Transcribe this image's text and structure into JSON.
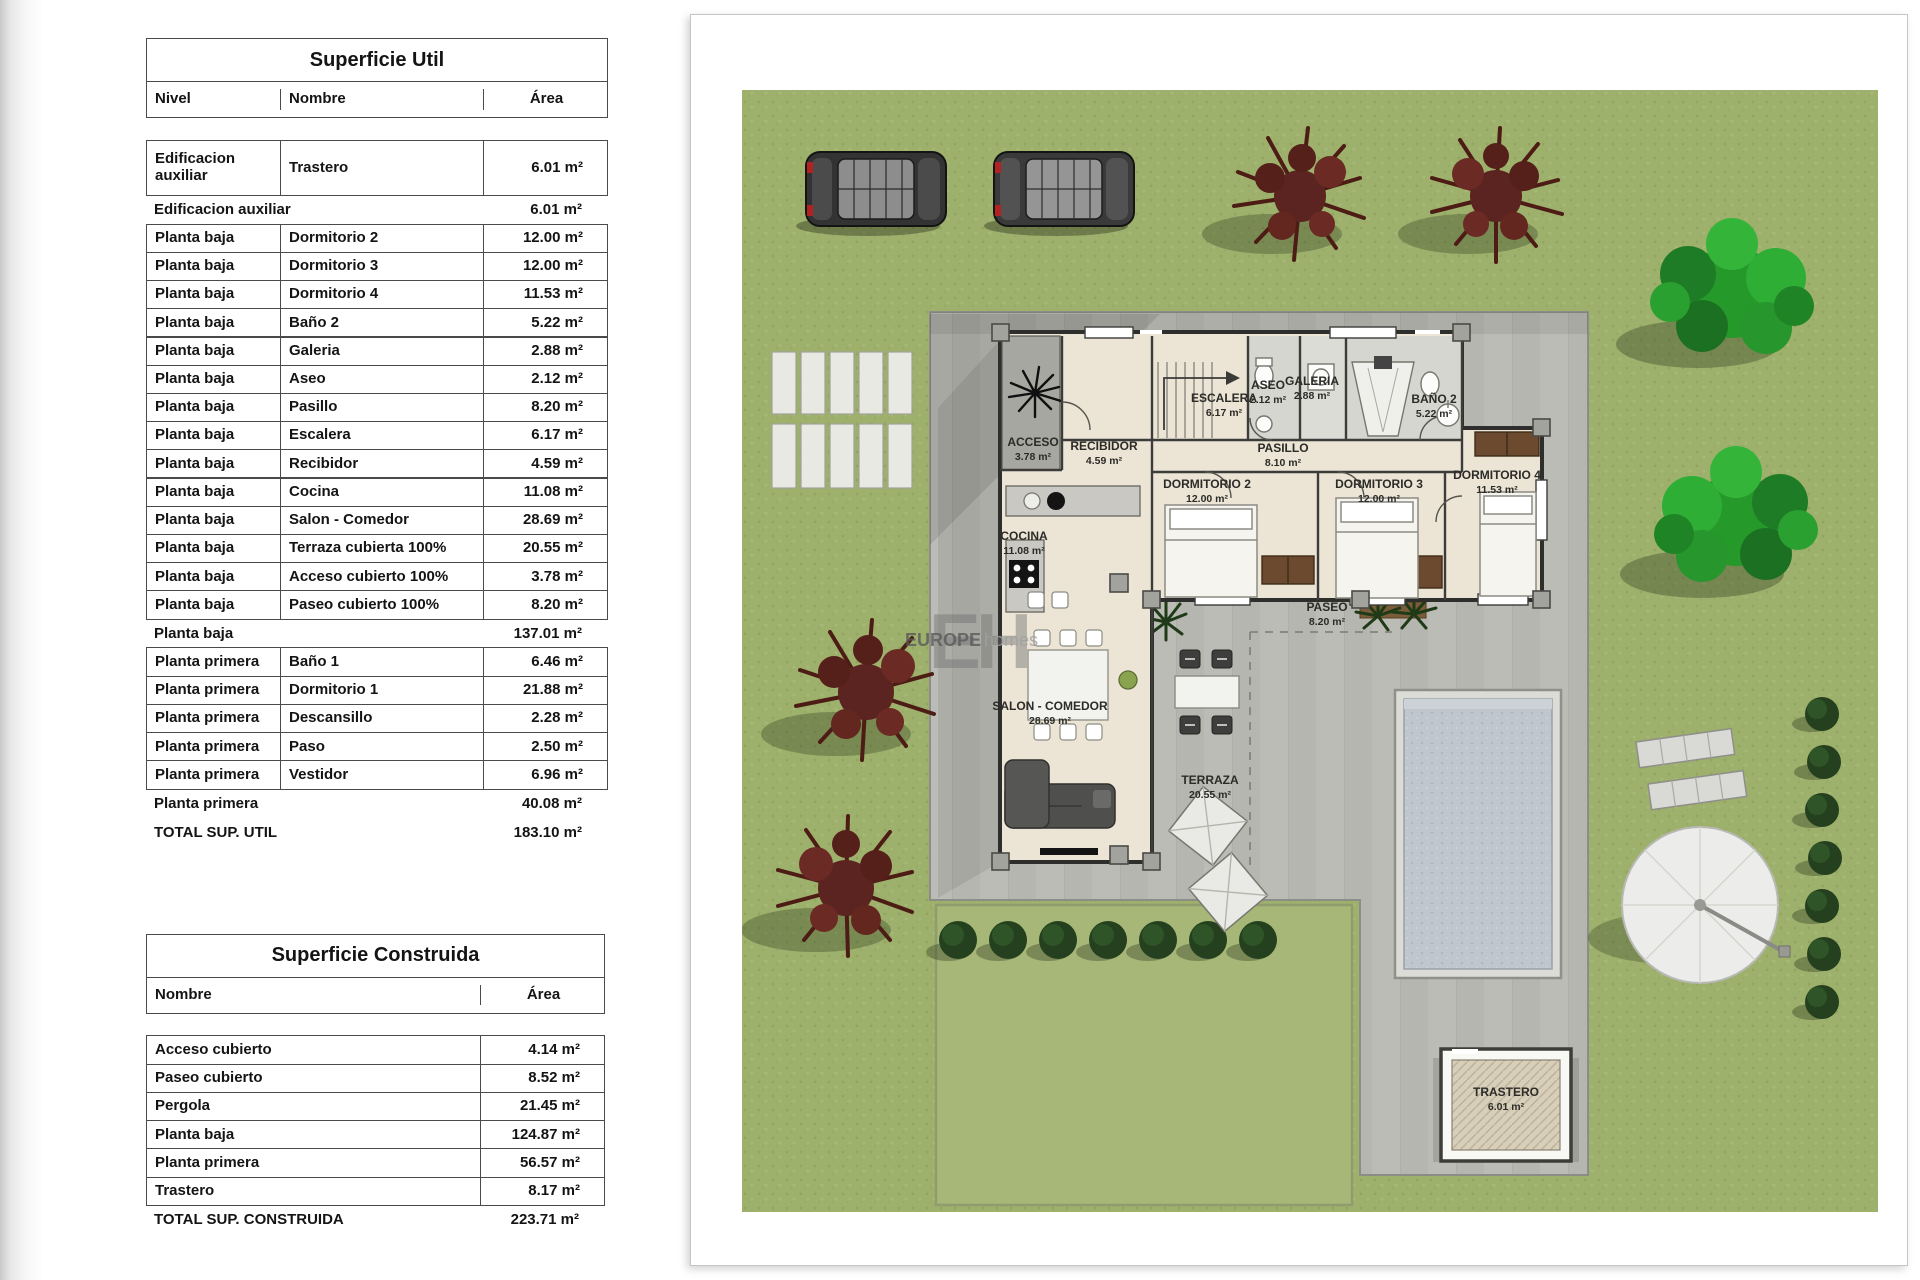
{
  "tables": [
    {
      "title": "Superficie Util",
      "columns": [
        "Nivel",
        "Nombre",
        "Área"
      ],
      "rows": [
        {
          "type": "tall",
          "nivel": "Edificacion auxiliar",
          "nombre": "Trastero",
          "area": "6.01 m²"
        },
        {
          "type": "sub",
          "label": "Edificacion auxiliar",
          "area": "6.01 m²"
        },
        {
          "type": "data",
          "nivel": "Planta baja",
          "nombre": "Dormitorio 2",
          "area": "12.00 m²"
        },
        {
          "type": "data",
          "nivel": "Planta baja",
          "nombre": "Dormitorio 3",
          "area": "12.00 m²"
        },
        {
          "type": "data",
          "nivel": "Planta baja",
          "nombre": "Dormitorio 4",
          "area": "11.53 m²"
        },
        {
          "type": "data",
          "nivel": "Planta baja",
          "nombre": "Baño 2",
          "area": "5.22 m²"
        },
        {
          "type": "data",
          "nivel": "Planta baja",
          "nombre": "Galeria",
          "area": "2.88 m²"
        },
        {
          "type": "data",
          "nivel": "Planta baja",
          "nombre": "Aseo",
          "area": "2.12 m²"
        },
        {
          "type": "data",
          "nivel": "Planta baja",
          "nombre": "Pasillo",
          "area": "8.20 m²"
        },
        {
          "type": "data",
          "nivel": "Planta baja",
          "nombre": "Escalera",
          "area": "6.17 m²"
        },
        {
          "type": "data",
          "nivel": "Planta baja",
          "nombre": "Recibidor",
          "area": "4.59 m²"
        },
        {
          "type": "data",
          "nivel": "Planta baja",
          "nombre": "Cocina",
          "area": "11.08 m²"
        },
        {
          "type": "data",
          "nivel": "Planta baja",
          "nombre": "Salon - Comedor",
          "area": "28.69 m²"
        },
        {
          "type": "data",
          "nivel": "Planta baja",
          "nombre": "Terraza cubierta 100%",
          "area": "20.55 m²"
        },
        {
          "type": "data",
          "nivel": "Planta baja",
          "nombre": "Acceso cubierto 100%",
          "area": "3.78 m²"
        },
        {
          "type": "data",
          "nivel": "Planta baja",
          "nombre": "Paseo cubierto 100%",
          "area": "8.20 m²"
        },
        {
          "type": "sub",
          "label": "Planta baja",
          "area": "137.01 m²"
        },
        {
          "type": "data",
          "nivel": "Planta primera",
          "nombre": "Baño 1",
          "area": "6.46 m²"
        },
        {
          "type": "data",
          "nivel": "Planta primera",
          "nombre": "Dormitorio 1",
          "area": "21.88 m²"
        },
        {
          "type": "data",
          "nivel": "Planta primera",
          "nombre": "Descansillo",
          "area": "2.28 m²"
        },
        {
          "type": "data",
          "nivel": "Planta primera",
          "nombre": "Paso",
          "area": "2.50 m²"
        },
        {
          "type": "data",
          "nivel": "Planta primera",
          "nombre": "Vestidor",
          "area": "6.96 m²"
        },
        {
          "type": "sub",
          "label": "Planta primera",
          "area": "40.08 m²"
        },
        {
          "type": "tot",
          "label": "TOTAL SUP. UTIL",
          "area": "183.10 m²"
        }
      ]
    },
    {
      "title": "Superficie Construida",
      "columns": [
        "Nombre",
        "Área"
      ],
      "rows": [
        {
          "type": "data",
          "nivel": "Acceso cubierto",
          "area": "4.14 m²"
        },
        {
          "type": "data",
          "nivel": "Paseo cubierto",
          "area": "8.52 m²"
        },
        {
          "type": "data",
          "nivel": "Pergola",
          "area": "21.45 m²"
        },
        {
          "type": "data",
          "nivel": "Planta baja",
          "area": "124.87 m²"
        },
        {
          "type": "data",
          "nivel": "Planta primera",
          "area": "56.57 m²"
        },
        {
          "type": "data",
          "nivel": "Trastero",
          "area": "8.17 m²"
        },
        {
          "type": "tot",
          "label": "TOTAL SUP. CONSTRUIDA",
          "area": "223.71 m²"
        }
      ]
    }
  ],
  "plan": {
    "watermark": {
      "monogram": "EH",
      "brand_bold": "EUROPE",
      "brand_light": "homes"
    },
    "labels": [
      {
        "name": "ACCESO",
        "area": "3.78 m²",
        "x": 1033,
        "y": 446
      },
      {
        "name": "RECIBIDOR",
        "area": "4.59 m²",
        "x": 1104,
        "y": 450
      },
      {
        "name": "ESCALERA",
        "area": "6.17 m²",
        "x": 1224,
        "y": 402
      },
      {
        "name": "ASEO",
        "area": "2.12 m²",
        "x": 1268,
        "y": 389
      },
      {
        "name": "GALERIA",
        "area": "2.88 m²",
        "x": 1312,
        "y": 385
      },
      {
        "name": "BAÑO 2",
        "area": "5.22 m²",
        "x": 1434,
        "y": 403
      },
      {
        "name": "PASILLO",
        "area": "8.10 m²",
        "x": 1283,
        "y": 452
      },
      {
        "name": "DORMITORIO 2",
        "area": "12.00 m²",
        "x": 1207,
        "y": 488
      },
      {
        "name": "DORMITORIO 3",
        "area": "12.00 m²",
        "x": 1379,
        "y": 488
      },
      {
        "name": "DORMITORIO 4",
        "area": "11.53 m²",
        "x": 1497,
        "y": 479
      },
      {
        "name": "COCINA",
        "area": "11.08 m²",
        "x": 1024,
        "y": 540
      },
      {
        "name": "SALON - COMEDOR",
        "area": "28.69 m²",
        "x": 1050,
        "y": 710
      },
      {
        "name": "TERRAZA",
        "area": "20.55 m²",
        "x": 1210,
        "y": 784
      },
      {
        "name": "PASEO",
        "area": "8.20 m²",
        "x": 1327,
        "y": 611
      },
      {
        "name": "TRASTERO",
        "area": "6.01 m²",
        "x": 1506,
        "y": 1096
      }
    ]
  }
}
